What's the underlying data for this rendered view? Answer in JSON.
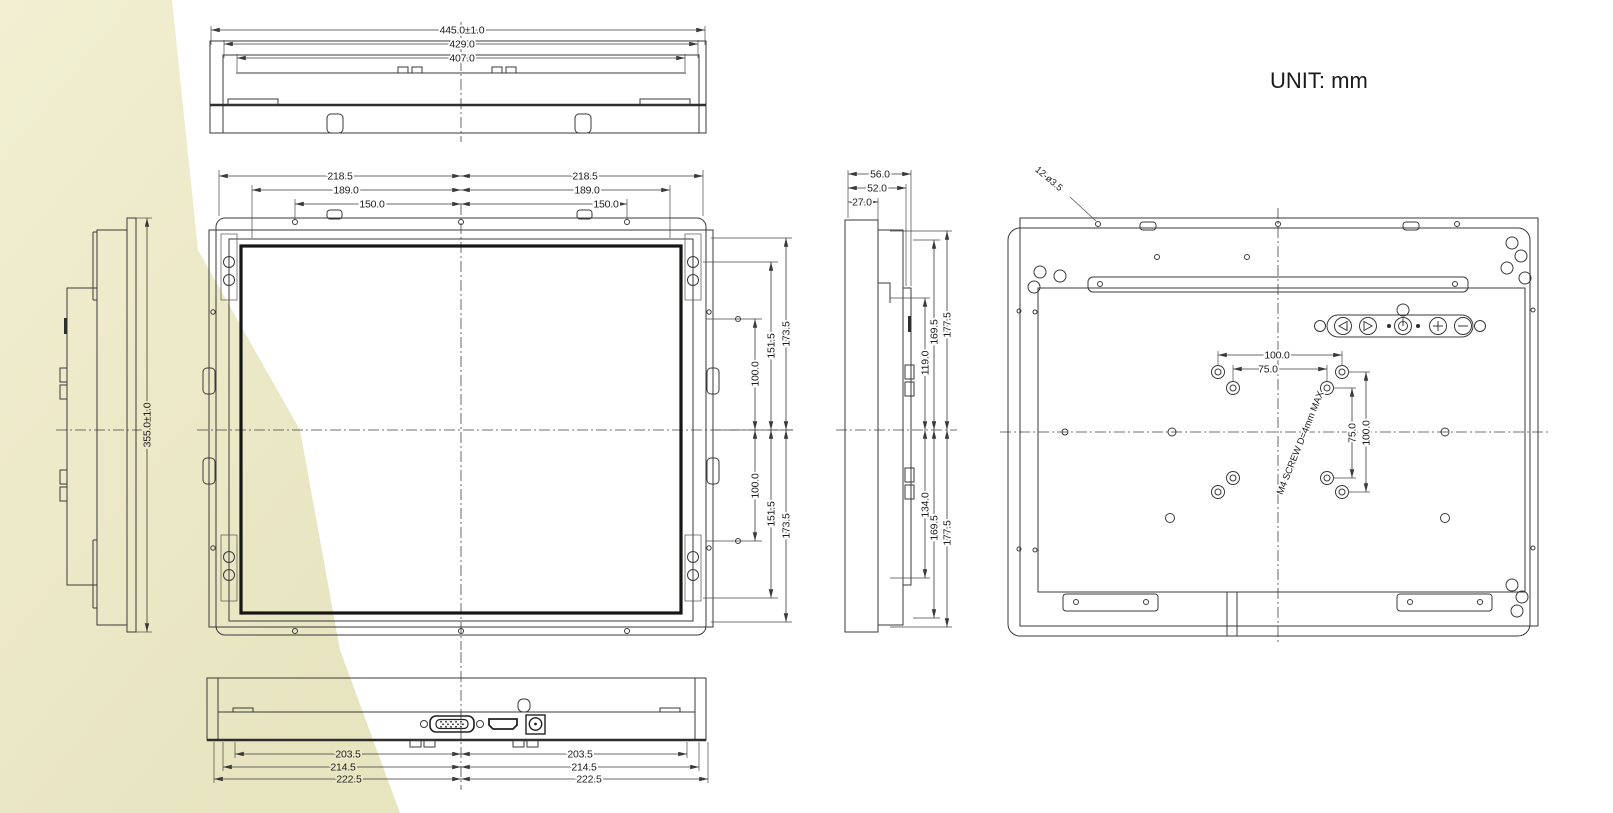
{
  "unit_label": "UNIT: mm",
  "top_view": {
    "dims": [
      "445.0±1.0",
      "429.0",
      "407.0"
    ]
  },
  "front_view": {
    "dims_top_left": [
      "218.5",
      "189.0",
      "150.0"
    ],
    "dims_top_right": [
      "218.5",
      "189.0",
      "150.0"
    ],
    "dims_right_upper": [
      "173.5",
      "151.5",
      "100.0"
    ],
    "dims_right_lower": [
      "173.5",
      "151.5",
      "100.0"
    ]
  },
  "left_view": {
    "dim_height": "355.0±1.0"
  },
  "side_view": {
    "dims_top": [
      "56.0",
      "52.0",
      "27.0"
    ],
    "dims_right_upper": [
      "177.5",
      "169.5",
      "119.0"
    ],
    "dims_right_lower": [
      "177.5",
      "169.5",
      "134.0"
    ]
  },
  "rear_view": {
    "hole_callout": "12-ø3.5",
    "screw_note": "M4 SCREW D=4mm MAX",
    "dims_h": [
      "100.0",
      "75.0"
    ],
    "dims_v": [
      "100.0",
      "75.0"
    ]
  },
  "bottom_view": {
    "dims_left": [
      "203.5",
      "214.5",
      "222.5"
    ],
    "dims_right": [
      "203.5",
      "214.5",
      "222.5"
    ]
  },
  "icons": {
    "osd_buttons": [
      "left",
      "right",
      "power",
      "plus",
      "minus"
    ]
  }
}
